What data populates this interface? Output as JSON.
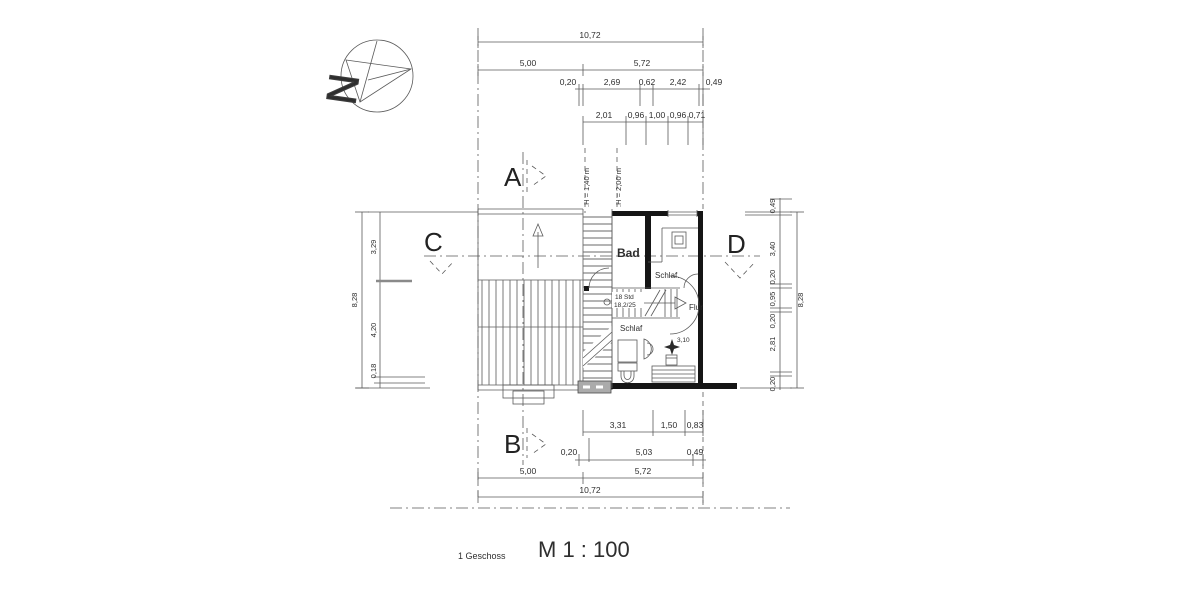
{
  "drawing": {
    "floor_label": "1 Geschoss",
    "scale_label": "M 1 : 100",
    "north_letter": "N"
  },
  "section_markers": {
    "a": "A",
    "b": "B",
    "c": "C",
    "d": "D"
  },
  "rooms": {
    "bad": "Bad",
    "schlaf_upper": "Schlaf.",
    "flur": "Flur",
    "schlaf_lower": "Schlaf"
  },
  "stair_note": {
    "line1": "18 Std",
    "line2": "18,2/25"
  },
  "heights": {
    "h1": ".H = 1,40 m",
    "h2": ".H = 2,00 m",
    "spot": "3,10"
  },
  "dimensions": {
    "top_total": "10,72",
    "top_row2": [
      "5,00",
      "5,72"
    ],
    "top_row3": [
      "0,20",
      "2,69",
      "0,62",
      "2,42",
      "0,49"
    ],
    "top_row4": [
      "2,01",
      "0,96",
      "1,00",
      "0,96",
      "0,71"
    ],
    "bottom_row1": [
      "3,31",
      "1,50",
      "0,83"
    ],
    "bottom_row2": [
      "0,20",
      "5,03",
      "0,49"
    ],
    "bottom_row3": [
      "5,00",
      "5,72"
    ],
    "bottom_total": "10,72",
    "left_total": "8,28",
    "left_segments": [
      "3,29",
      "4,20",
      "0,18"
    ],
    "right_total": "8,28",
    "right_segments": [
      "0,49",
      "3,40",
      "0,20",
      "0,95",
      "0,20",
      "2,81",
      "0,20"
    ]
  }
}
